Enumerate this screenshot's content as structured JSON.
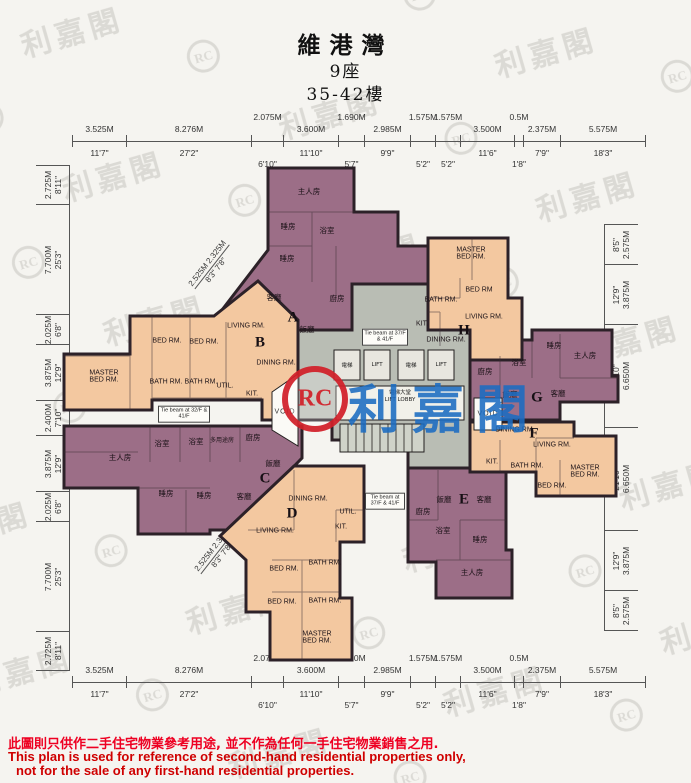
{
  "header": {
    "estate": "維港灣",
    "block": "9座",
    "floors": "35-42樓"
  },
  "watermark": {
    "brand": "利嘉閣",
    "monogram": "RC"
  },
  "core": {
    "lift_zh": "電梯",
    "lift_en": "LIFT",
    "lobby_zh": "電梯大堂",
    "lobby_en": "LIFT LOBBY",
    "void": "VOID",
    "tie_beam_37": "Tie beam at 37/F & 41/F",
    "tie_beam_32": "Tie beam at 32/F & 41/F"
  },
  "dimensions": {
    "top": [
      {
        "m": "3.525M",
        "ft": "11'7\""
      },
      {
        "m": "8.276M",
        "ft": "27'2\""
      },
      {
        "m": "2.075M",
        "ft": "6'10\""
      },
      {
        "m": "3.600M",
        "ft": "11'10\""
      },
      {
        "m": "1.690M",
        "ft": "5'7\""
      },
      {
        "m": "2.985M",
        "ft": "9'9\""
      },
      {
        "m": "1.575M",
        "ft": "5'2\""
      },
      {
        "m": "1.575M",
        "ft": "5'2\""
      },
      {
        "m": "3.500M",
        "ft": "11'6\""
      },
      {
        "m": "0.5M",
        "ft": "1'8\""
      },
      {
        "m": "2.375M",
        "ft": "7'9\""
      },
      {
        "m": "5.575M",
        "ft": "18'3\""
      }
    ],
    "bottom": [
      {
        "m": "3.525M",
        "ft": "11'7\""
      },
      {
        "m": "8.276M",
        "ft": "27'2\""
      },
      {
        "m": "2.075M",
        "ft": "6'10\""
      },
      {
        "m": "3.600M",
        "ft": "11'10\""
      },
      {
        "m": "1.690M",
        "ft": "5'7\""
      },
      {
        "m": "2.985M",
        "ft": "9'9\""
      },
      {
        "m": "1.575M",
        "ft": "5'2\""
      },
      {
        "m": "1.575M",
        "ft": "5'2\""
      },
      {
        "m": "3.500M",
        "ft": "11'6\""
      },
      {
        "m": "0.5M",
        "ft": "1'8\""
      },
      {
        "m": "2.375M",
        "ft": "7'9\""
      },
      {
        "m": "5.575M",
        "ft": "18'3\""
      }
    ],
    "left": [
      {
        "m": "2.725M",
        "ft": "8'11\""
      },
      {
        "m": "7.700M",
        "ft": "25'3\""
      },
      {
        "m": "2.025M",
        "ft": "6'8\""
      },
      {
        "m": "3.875M",
        "ft": "12'9\""
      },
      {
        "m": "2.400M",
        "ft": "7'10\""
      },
      {
        "m": "3.875M",
        "ft": "12'9\""
      },
      {
        "m": "2.025M",
        "ft": "6'8\""
      },
      {
        "m": "7.700M",
        "ft": "25'3\""
      },
      {
        "m": "2.725M",
        "ft": "8'11\""
      }
    ],
    "right": [
      {
        "m": "2.575M",
        "ft": "8'5\""
      },
      {
        "m": "3.875M",
        "ft": "12'9\""
      },
      {
        "m": "6.650M",
        "ft": "21'10\""
      },
      {
        "m": "6.650M",
        "ft": "21'10\""
      },
      {
        "m": "3.875M",
        "ft": "12'9\""
      },
      {
        "m": "2.575M",
        "ft": "8'5\""
      }
    ],
    "diagonal": {
      "m": "2.525M 2.325M",
      "ft": "8'3\"  7'8\""
    }
  },
  "units": {
    "A": {
      "letter": "A",
      "rooms": [
        "主人房",
        "睡房",
        "睡房",
        "浴室",
        "客廳",
        "廚房",
        "飯廳"
      ]
    },
    "B": {
      "letter": "B",
      "rooms": [
        "BED RM.",
        "BED RM.",
        "MASTER BED RM.",
        "BATH RM.",
        "BATH RM.",
        "UTIL.",
        "KIT.",
        "LIVING RM.",
        "DINING RM."
      ]
    },
    "C": {
      "letter": "C",
      "rooms": [
        "主人房",
        "浴室",
        "浴室",
        "多用途房",
        "廚房",
        "飯廳",
        "睡房",
        "睡房",
        "客廳"
      ]
    },
    "D": {
      "letter": "D",
      "rooms": [
        "DINING RM.",
        "LIVING RM.",
        "UTIL.",
        "KIT.",
        "BATH RM.",
        "BED RM.",
        "BED RM.",
        "BATH RM.",
        "MASTER BED RM."
      ]
    },
    "E": {
      "letter": "E",
      "rooms": [
        "飯廳",
        "客廳",
        "廚房",
        "浴室",
        "睡房",
        "主人房"
      ]
    },
    "F": {
      "letter": "F",
      "rooms": [
        "DINING RM.",
        "LIVING RM.",
        "KIT.",
        "BATH RM.",
        "BED RM.",
        "MASTER BED RM."
      ]
    },
    "G": {
      "letter": "G",
      "rooms": [
        "睡房",
        "主人房",
        "廚房",
        "浴室",
        "飯廳",
        "客廳"
      ]
    },
    "H": {
      "letter": "H",
      "rooms": [
        "MASTER BED RM.",
        "BED RM",
        "BATH RM.",
        "KIT.",
        "LIVING RM.",
        "DINING RM."
      ]
    }
  },
  "footer": {
    "zh": "此圖則只供作二手住宅物業參考用途, 並不作為任何一手住宅物業銷售之用.",
    "en1": "This plan is used for reference of second-hand residential properties only,",
    "en2": "not for the sale of any first-hand residential properties."
  }
}
